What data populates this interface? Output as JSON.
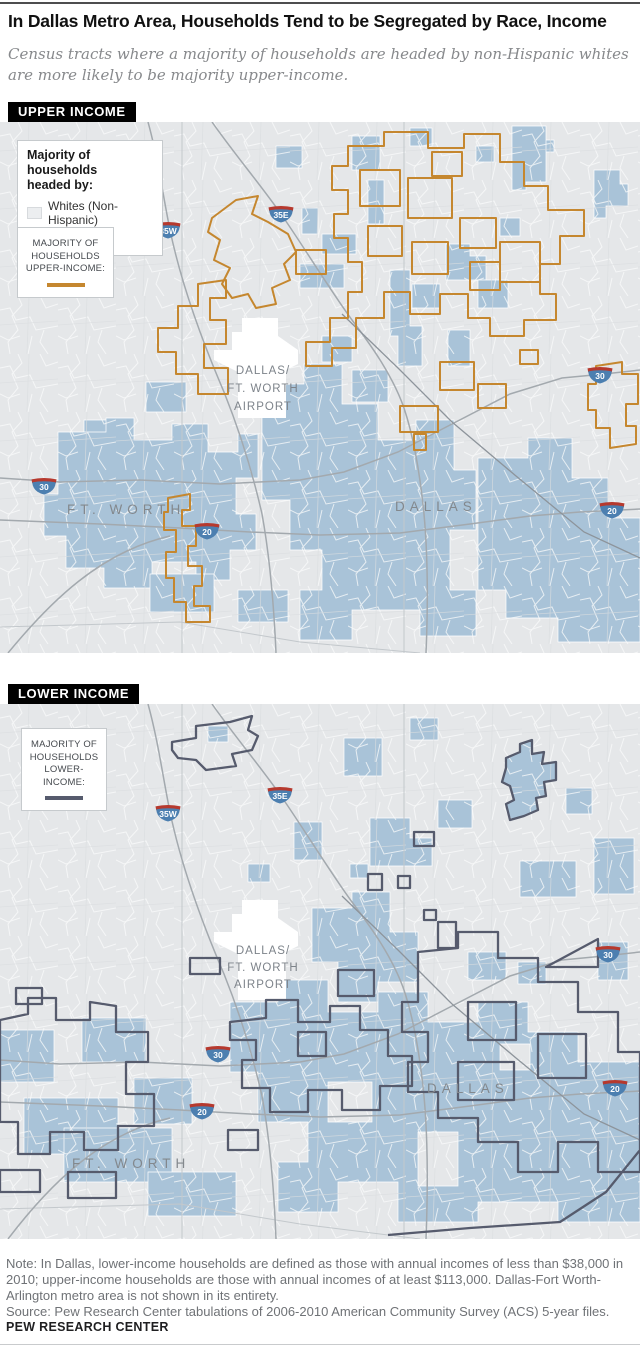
{
  "page": {
    "title": "In Dallas Metro Area, Households Tend to be Segregated by Race, Income",
    "subtitle_lines": [
      "Census tracts where a majority of households are headed by non-Hispanic whites",
      "are more likely to be majority upper-income."
    ]
  },
  "maps": [
    {
      "tag": "UPPER INCOME",
      "legend_race": {
        "title_lines": [
          "Majority of households",
          "headed by:"
        ],
        "items": [
          {
            "label": "Whites (Non-Hispanic)"
          },
          {
            "label": "Non-whites"
          }
        ]
      },
      "legend_income": {
        "lines": [
          "MAJORITY OF",
          "HOUSEHOLDS",
          "UPPER-INCOME:"
        ]
      },
      "labels": {
        "airport_lines": [
          "DALLAS/",
          "FT. WORTH",
          "AIRPORT"
        ],
        "city_west": "FT. WORTH",
        "city_east": "DALLAS"
      },
      "shields": [
        "35W",
        "35E",
        "30",
        "20",
        "30",
        "20"
      ]
    },
    {
      "tag": "LOWER INCOME",
      "legend_income": {
        "lines": [
          "MAJORITY OF",
          "HOUSEHOLDS",
          "LOWER-INCOME:"
        ]
      },
      "labels": {
        "airport_lines": [
          "DALLAS/",
          "FT. WORTH",
          "AIRPORT"
        ],
        "city_west": "FT. WORTH",
        "city_east": "DALLAS"
      },
      "shields": [
        "35W",
        "35E",
        "30",
        "20",
        "30",
        "20"
      ]
    }
  ],
  "footer": {
    "note": "Note: In Dallas, lower-income households are defined as those with annual incomes of less than $38,000 in 2010; upper-income households are those with annual incomes of at least $113,000. Dallas-Fort Worth-Arlington metro area is not shown in its entirety.",
    "source": "Source: Pew Research Center tabulations of 2006-2010 American Community Survey (ACS) 5-year files.",
    "brand": "PEW RESEARCH CENTER"
  },
  "colors": {
    "tag_bg": "#000000",
    "map_bg": "#e5e7e9",
    "nonwhite": "#a9c3d8",
    "white_tract": "#eceef0",
    "upper": "#c5872f",
    "lower": "#565b6d",
    "road": "#a3a9ae",
    "shield_blue": "#4c7fb0",
    "shield_red": "#b6392e"
  }
}
